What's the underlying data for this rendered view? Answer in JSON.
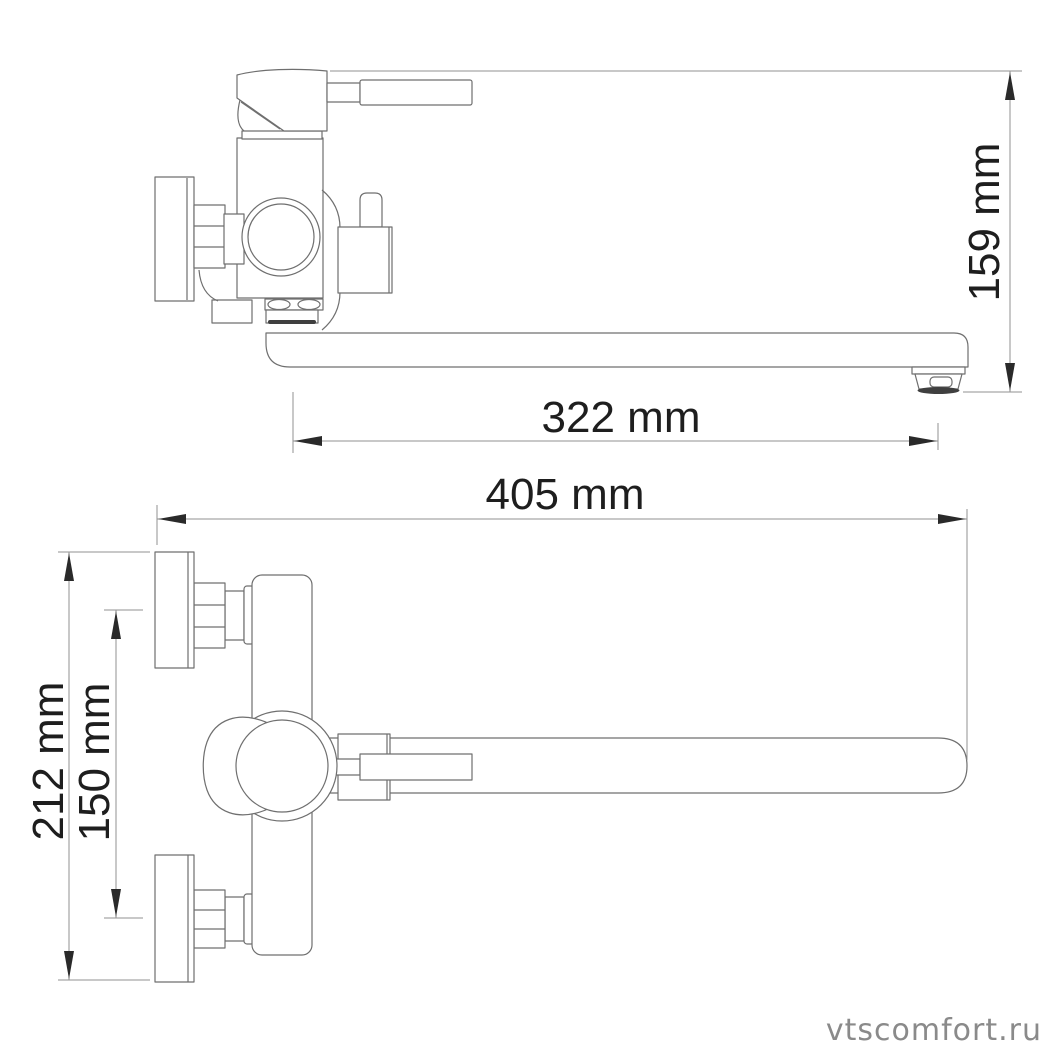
{
  "drawing": {
    "title": "wall-mounted-bath-mixer-technical-drawing",
    "views": {
      "side_view": "faucet side projection with long spout",
      "plan_view": "faucet top-down projection"
    }
  },
  "dims": {
    "d159": {
      "label": "159 mm",
      "value": 159,
      "unit": "mm"
    },
    "d322": {
      "label": "322 mm",
      "value": 322,
      "unit": "mm"
    },
    "d405": {
      "label": "405 mm",
      "value": 405,
      "unit": "mm"
    },
    "d212": {
      "label": "212 mm",
      "value": 212,
      "unit": "mm"
    },
    "d150": {
      "label": "150 mm",
      "value": 150,
      "unit": "mm"
    }
  },
  "watermark": {
    "text": "vtscomfort.ru"
  },
  "colors": {
    "background": "#ffffff",
    "line": "#6f6f6f",
    "dim_line": "#909090",
    "arrow": "#2a2a2a",
    "text": "#1e1e1e",
    "dark_band": "#3f3f3f",
    "watermark": "#8a8a8a"
  }
}
